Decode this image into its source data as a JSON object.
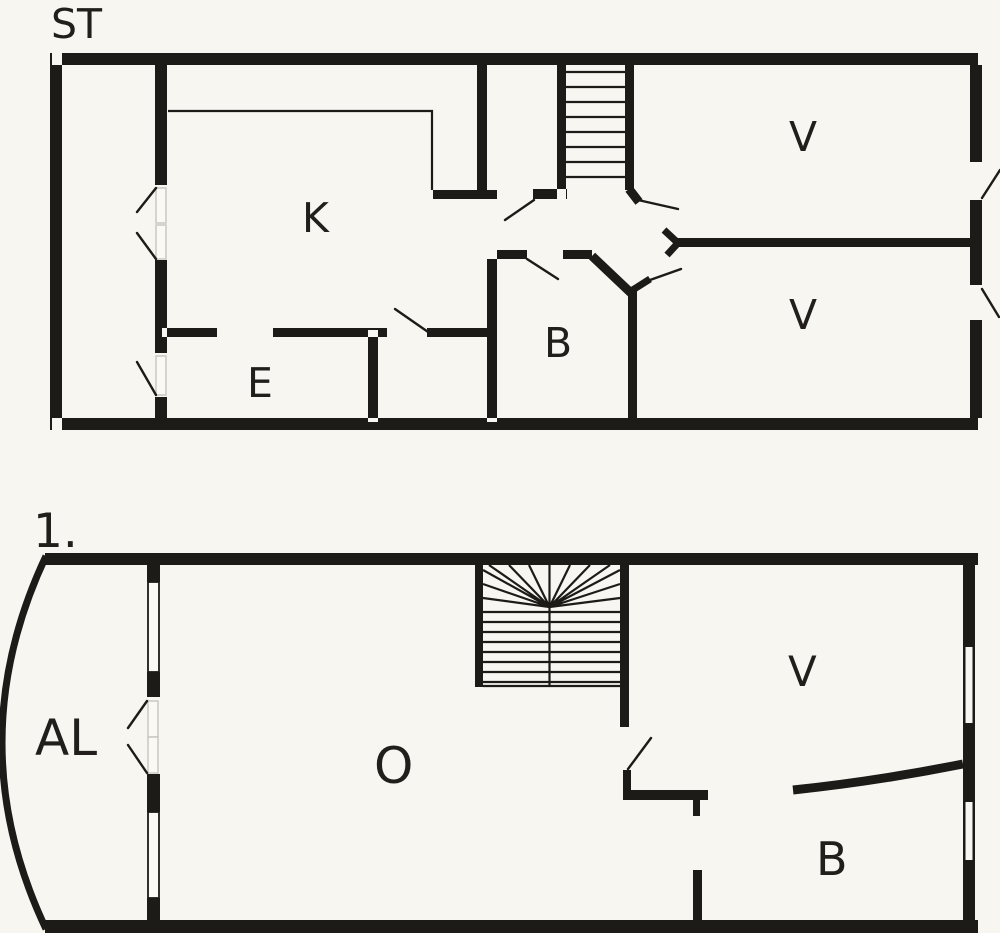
{
  "page": {
    "background": "#f7f6f0",
    "ink": "#1d1b18",
    "title": "Floor plan"
  },
  "floors": [
    {
      "id": "st",
      "label": "ST",
      "rooms": [
        {
          "key": "k",
          "label": "K"
        },
        {
          "key": "e",
          "label": "E"
        },
        {
          "key": "b",
          "label": "B"
        },
        {
          "key": "v1",
          "label": "V"
        },
        {
          "key": "v2",
          "label": "V"
        }
      ]
    },
    {
      "id": "first",
      "label": "1.",
      "rooms": [
        {
          "key": "al",
          "label": "AL"
        },
        {
          "key": "o",
          "label": "O"
        },
        {
          "key": "v",
          "label": "V"
        },
        {
          "key": "b",
          "label": "B"
        }
      ]
    }
  ]
}
